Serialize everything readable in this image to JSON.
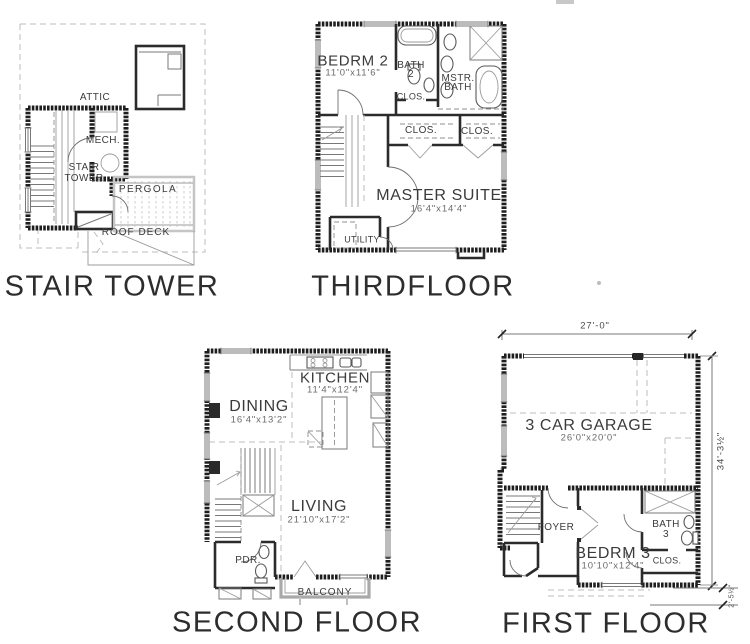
{
  "page": {
    "background": "#ffffff"
  },
  "plans": {
    "stair_tower": {
      "title": "STAIR TOWER",
      "labels": {
        "attic": "ATTIC",
        "mech": "MECH.",
        "stair_line1": "STAIR",
        "stair_line2": "TOWER",
        "pergola": "PERGOLA",
        "roof_deck": "ROOF DECK"
      }
    },
    "third_floor": {
      "title": "THIRDFLOOR",
      "rooms": {
        "bedrm2_name": "BEDRM 2",
        "bedrm2_dims": "11'0\"x11'6\"",
        "bath2_line1": "BATH",
        "bath2_line2": "2",
        "mstr_bath_line1": "MSTR.",
        "mstr_bath_line2": "BATH",
        "clos_top": "CLOS.",
        "clos_left": "CLOS.",
        "clos_right": "CLOS.",
        "master_name": "MASTER SUITE",
        "master_dims": "16'4\"x14'4\"",
        "utility": "UTILITY"
      }
    },
    "second_floor": {
      "title": "SECOND FLOOR",
      "rooms": {
        "kitchen_name": "KITCHEN",
        "kitchen_dims": "11'4\"x12'4\"",
        "dining_name": "DINING",
        "dining_dims": "16'4\"x13'2\"",
        "living_name": "LIVING",
        "living_dims": "21'10\"x17'2\"",
        "pdr": "PDR.",
        "balcony": "BALCONY"
      }
    },
    "first_floor": {
      "title": "FIRST FLOOR",
      "rooms": {
        "garage_name": "3 CAR GARAGE",
        "garage_dims": "26'0\"x20'0\"",
        "foyer": "FOYER",
        "bedrm3_name": "BEDRM 3",
        "bedrm3_dims": "10'10\"x12'4\"",
        "bath3_line1": "BATH",
        "bath3_line2": "3",
        "clos": "CLOS."
      },
      "dimensions": {
        "overall_width": "27'-0\"",
        "overall_height": "34'-3½\"",
        "rear_offset": "2'-5½\""
      }
    }
  }
}
